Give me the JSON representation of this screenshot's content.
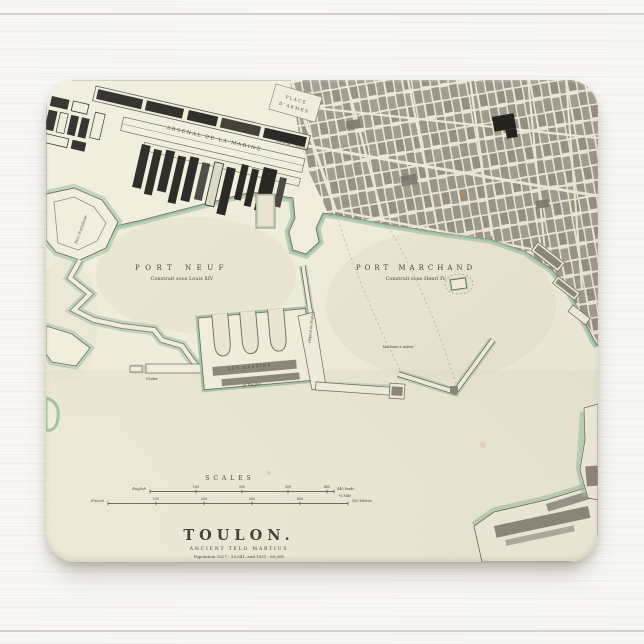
{
  "product": {
    "description": "Vintage map of Toulon printed on a rectangular mousepad, photographed on white painted wood"
  },
  "colors": {
    "paper": "#f0ecdb",
    "water_wash": "#e2deca",
    "shore_green": "#9fc3a5",
    "shore_green_dark": "#7dae90",
    "city_block_gray": "#9d978a",
    "building_black": "#26231f",
    "ink": "#47423a",
    "wood_background": "#f8f7f4"
  },
  "title_block": {
    "title": "TOULON.",
    "subtitle": "ANCIENT TELO MARTIUS",
    "population": "Population 1827 - 33,041, and 1851 - 69,081",
    "imprint": "Published by the Society for the Diffusion of Useful Knowledge."
  },
  "harbors": {
    "port_neuf": {
      "name": "PORT NEUF",
      "caption": "Construit sous Louis XIV"
    },
    "port_marchand": {
      "name": "PORT MARCHAND",
      "caption": "Construit sous Henri IV."
    }
  },
  "places": {
    "arsenal": "ARSENAL DE LA MARINE",
    "place_darmes_line1": "PLACE",
    "place_darmes_line2": "D'ARMES",
    "porte_arsenal": "Porte de l'Arsenal",
    "les_bassins": "LES BASSINS",
    "le_bagne": "le Bagne",
    "chaine": "Chaîne",
    "hopital_du_bagne": "Hôpital du Bagne",
    "machine_a_mater": "Machine à mâter",
    "parc_artillerie": "Parc d'artillerie"
  },
  "scales": {
    "heading": "SCALES",
    "english": {
      "label": "English",
      "ticks": [
        "100",
        "200",
        "300",
        "400"
      ],
      "end": "440 Yards",
      "note": "¼ Mile"
    },
    "french": {
      "label": "French",
      "ticks": [
        "100",
        "200",
        "300",
        "400"
      ],
      "end": "500 Mètres"
    }
  }
}
